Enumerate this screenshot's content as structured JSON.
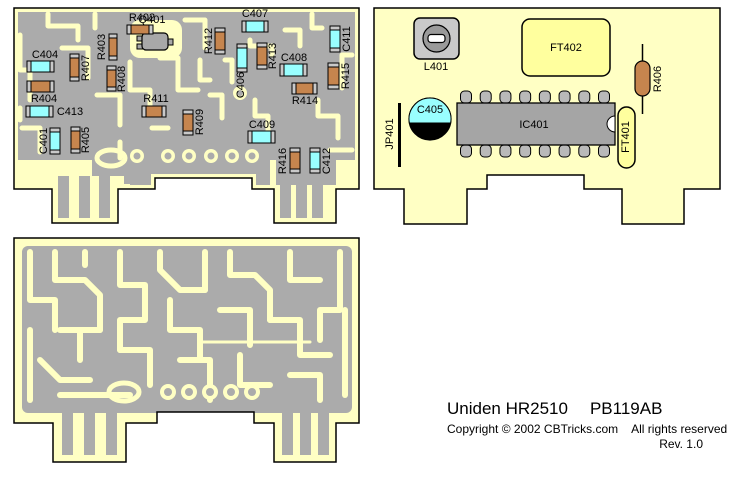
{
  "footer": {
    "title_left": "Uniden HR2510",
    "title_right": "PB119AB",
    "copyright_left": "Copyright © 2002 CBTricks.com",
    "copyright_right": "All rights reserved",
    "revision": "Rev. 1.0"
  },
  "colors": {
    "board_yellow": "#FFFFC4",
    "copper_gray": "#ABABAB",
    "resistor_brown": "#C6854E",
    "capacitor_cyan": "#99FFFF",
    "component_gray": "#A8A8A8",
    "pin_gray": "#B9B9B9",
    "cap_end_gray": "#C9C9C9",
    "filter_yellow": "#FFFF9E",
    "slot_white": "#FFFFFF",
    "outline": "#000000"
  },
  "boards": {
    "smd_side": {
      "components": [
        {
          "id": "Q401",
          "type": "transistor",
          "x": 142,
          "y": 33,
          "w": 26,
          "h": 17,
          "label": "Q401",
          "lx": 152,
          "ly": 20,
          "rot": 0
        },
        {
          "id": "R402",
          "type": "chip",
          "color": "r",
          "orient": "h",
          "x": 127,
          "y": 25,
          "w": 26,
          "h": 9,
          "label": "R402",
          "lx": 142,
          "ly": 18,
          "rot": 0
        },
        {
          "id": "R403",
          "type": "chip",
          "color": "r",
          "orient": "v",
          "x": 109,
          "y": 34,
          "w": 8,
          "h": 26,
          "label": "R403",
          "lx": 102,
          "ly": 47,
          "rot": -90
        },
        {
          "id": "R407",
          "type": "chip",
          "color": "r",
          "orient": "v",
          "x": 70,
          "y": 54,
          "w": 9,
          "h": 27,
          "label": "R407",
          "lx": 86,
          "ly": 68,
          "rot": -90
        },
        {
          "id": "C404",
          "type": "chip",
          "color": "c",
          "orient": "h",
          "x": 27,
          "y": 61,
          "w": 27,
          "h": 11,
          "label": "C404",
          "lx": 45,
          "ly": 55,
          "rot": 0
        },
        {
          "id": "R404",
          "type": "chip",
          "color": "r",
          "orient": "h",
          "x": 27,
          "y": 81,
          "w": 27,
          "h": 11,
          "label": "R404",
          "lx": 44,
          "ly": 99,
          "rot": 0
        },
        {
          "id": "C413",
          "type": "chip",
          "color": "c",
          "orient": "h",
          "x": 26,
          "y": 106,
          "w": 27,
          "h": 11,
          "label": "C413",
          "lx": 70,
          "ly": 112,
          "rot": 0
        },
        {
          "id": "R408",
          "type": "chip",
          "color": "r",
          "orient": "v",
          "x": 107,
          "y": 66,
          "w": 9,
          "h": 25,
          "label": "R408",
          "lx": 122,
          "ly": 79,
          "rot": -90
        },
        {
          "id": "R411",
          "type": "chip",
          "color": "r",
          "orient": "h",
          "x": 142,
          "y": 106,
          "w": 24,
          "h": 11,
          "label": "R411",
          "lx": 156,
          "ly": 99,
          "rot": 0
        },
        {
          "id": "C401",
          "type": "chip",
          "color": "c",
          "orient": "v",
          "x": 50,
          "y": 128,
          "w": 10,
          "h": 26,
          "label": "C401",
          "lx": 44,
          "ly": 141,
          "rot": -90
        },
        {
          "id": "R405",
          "type": "chip",
          "color": "r",
          "orient": "v",
          "x": 71,
          "y": 127,
          "w": 9,
          "h": 26,
          "label": "R405",
          "lx": 86,
          "ly": 140,
          "rot": -90
        },
        {
          "id": "R409",
          "type": "chip",
          "color": "r",
          "orient": "v",
          "x": 183,
          "y": 110,
          "w": 10,
          "h": 25,
          "label": "R409",
          "lx": 200,
          "ly": 122,
          "rot": -90
        },
        {
          "id": "C409",
          "type": "chip",
          "color": "c",
          "orient": "h",
          "x": 248,
          "y": 131,
          "w": 27,
          "h": 12,
          "label": "C409",
          "lx": 262,
          "ly": 125,
          "rot": 0
        },
        {
          "id": "R416",
          "type": "chip",
          "color": "r",
          "orient": "v",
          "x": 290,
          "y": 148,
          "w": 10,
          "h": 25,
          "label": "R416",
          "lx": 283,
          "ly": 161,
          "rot": -90
        },
        {
          "id": "C412",
          "type": "chip",
          "color": "c",
          "orient": "v",
          "x": 310,
          "y": 148,
          "w": 10,
          "h": 25,
          "label": "C412",
          "lx": 327,
          "ly": 161,
          "rot": -90
        },
        {
          "id": "R412",
          "type": "chip",
          "color": "r",
          "orient": "v",
          "x": 215,
          "y": 28,
          "w": 10,
          "h": 26,
          "label": "R412",
          "lx": 209,
          "ly": 41,
          "rot": -90
        },
        {
          "id": "C407",
          "type": "chip",
          "color": "c",
          "orient": "h",
          "x": 242,
          "y": 21,
          "w": 26,
          "h": 11,
          "label": "C407",
          "lx": 255,
          "ly": 14,
          "rot": 0
        },
        {
          "id": "C406",
          "type": "chip",
          "color": "c",
          "orient": "v",
          "x": 237,
          "y": 44,
          "w": 10,
          "h": 28,
          "label": "C406",
          "lx": 241,
          "ly": 85,
          "rot": -90
        },
        {
          "id": "R413",
          "type": "chip",
          "color": "r",
          "orient": "v",
          "x": 257,
          "y": 43,
          "w": 10,
          "h": 26,
          "label": "R413",
          "lx": 273,
          "ly": 56,
          "rot": -90
        },
        {
          "id": "C408",
          "type": "chip",
          "color": "c",
          "orient": "h",
          "x": 280,
          "y": 64,
          "w": 27,
          "h": 12,
          "label": "C408",
          "lx": 294,
          "ly": 58,
          "rot": 0
        },
        {
          "id": "C411",
          "type": "chip",
          "color": "c",
          "orient": "v",
          "x": 330,
          "y": 26,
          "w": 10,
          "h": 26,
          "label": "C411",
          "lx": 347,
          "ly": 39,
          "rot": -90
        },
        {
          "id": "R415",
          "type": "chip",
          "color": "r",
          "orient": "v",
          "x": 328,
          "y": 63,
          "w": 11,
          "h": 26,
          "label": "R415",
          "lx": 346,
          "ly": 76,
          "rot": -90
        },
        {
          "id": "R414",
          "type": "chip",
          "color": "r",
          "orient": "h",
          "x": 292,
          "y": 83,
          "w": 25,
          "h": 11,
          "label": "R414",
          "lx": 305,
          "ly": 101,
          "rot": 0
        }
      ]
    },
    "component_side": {
      "components": [
        {
          "id": "L401",
          "type": "coil",
          "x": 414,
          "y": 18,
          "w": 45,
          "h": 41,
          "label": "L401",
          "lx": 436,
          "ly": 67,
          "rot": 0
        },
        {
          "id": "FT402",
          "type": "frect",
          "x": 522,
          "y": 19,
          "w": 88,
          "h": 57,
          "label": "FT402",
          "lx": 566,
          "ly": 48,
          "rot": 0
        },
        {
          "id": "R406",
          "type": "axial",
          "x": 635,
          "y": 61,
          "w": 15,
          "h": 35,
          "lead_top": 44,
          "lead_bot": 114,
          "label": "R406",
          "lx": 658,
          "ly": 79,
          "rot": -90
        },
        {
          "id": "IC401",
          "type": "dip",
          "x": 457,
          "y": 103,
          "w": 158,
          "h": 42,
          "pins": 8,
          "label": "IC401",
          "lx": 534,
          "ly": 125,
          "rot": 0
        },
        {
          "id": "C405",
          "type": "ecap",
          "cx": 430,
          "cy": 119,
          "r": 21,
          "label": "C405",
          "lx": 430,
          "ly": 110,
          "rot": 0
        },
        {
          "id": "JP401",
          "type": "jumper",
          "x": 398,
          "y": 103,
          "w": 3,
          "h": 64,
          "label": "JP401",
          "lx": 390,
          "ly": 134,
          "rot": -90
        },
        {
          "id": "FT401",
          "type": "foval",
          "x": 618,
          "y": 107,
          "w": 17,
          "h": 61,
          "label": "FT401",
          "lx": 626,
          "ly": 137,
          "rot": -90
        }
      ]
    },
    "solder_side": {}
  }
}
